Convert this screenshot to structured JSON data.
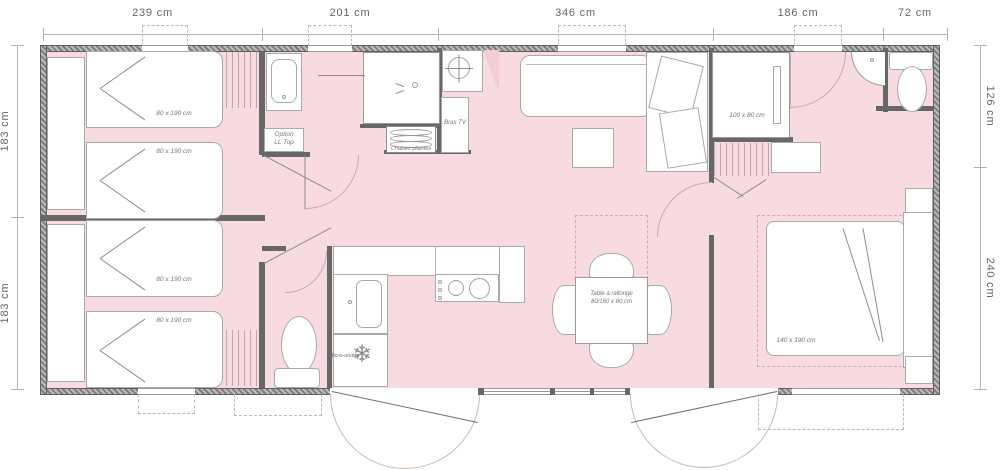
{
  "plan_type": "mobile-home-floorplan",
  "dimensions": {
    "top": [
      "239 cm",
      "201 cm",
      "346 cm",
      "186 cm",
      "72 cm"
    ],
    "left": [
      "183 cm",
      "183 cm"
    ],
    "right": [
      "126 cm",
      "240 cm"
    ]
  },
  "rooms": {
    "bedroom1": {
      "bed_a": "80 x 190 cm",
      "bed_b": "80 x 190 cm"
    },
    "bedroom2": {
      "bed_a": "80 x 190 cm",
      "bed_b": "80 x 190 cm"
    },
    "bathroom": {
      "option_line1": "Option",
      "option_line2": "LL Top",
      "chairs": "Chaises pliantes",
      "tv_bracket": "Bras TV"
    },
    "kitchen": {
      "microwave": "Micro-ondes",
      "freezer_icon": "❄"
    },
    "dining": {
      "table_line1": "Table à rallonge",
      "table_line2": "80/160 x 80 cm"
    },
    "master": {
      "bed": "140 x 190 cm",
      "shower": "100 x 80 cm"
    }
  },
  "colors": {
    "floor_pink": "#f7dbe1",
    "floor_pink_light": "#f3ccd5",
    "wall_gray": "#676767",
    "outline_gray": "#a9a9a9",
    "text_gray": "#64646c"
  }
}
